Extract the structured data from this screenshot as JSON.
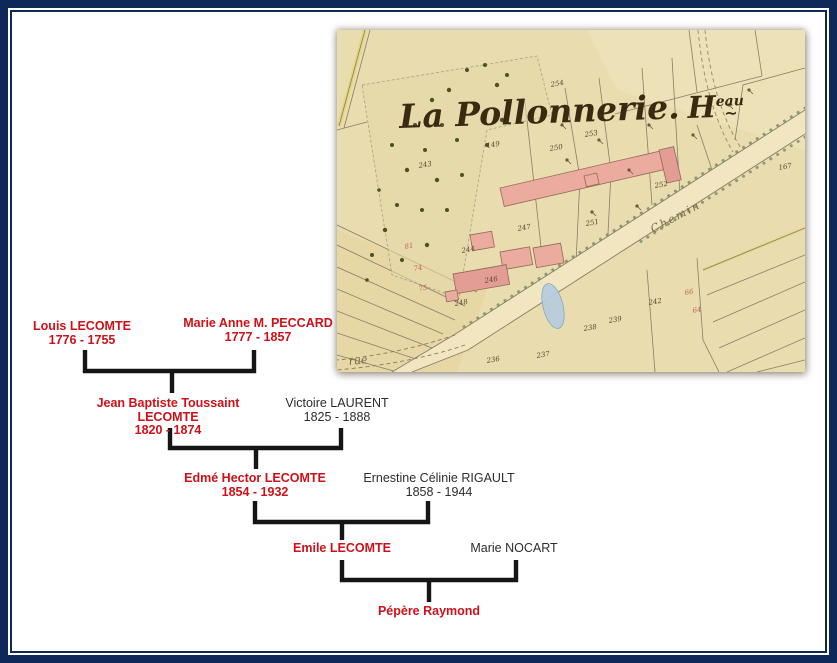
{
  "frame": {
    "border_color": "#0e2859"
  },
  "map": {
    "title_main": "La Pollonnerie.",
    "title_h": "H",
    "title_sup": "eau",
    "road_label": "Chemin",
    "corner_label": "rue",
    "paper_color": "#e9dcae",
    "building_color": "#ecab9f",
    "pond_color": "#b7cedd",
    "ink_color": "#857f68",
    "title_ink": "#3a2a12",
    "parcel_numbers": [
      {
        "t": "254",
        "x": 214,
        "y": 57,
        "c": "d"
      },
      {
        "t": "149",
        "x": 150,
        "y": 118,
        "c": "d"
      },
      {
        "t": "243",
        "x": 82,
        "y": 138,
        "c": "d"
      },
      {
        "t": "250",
        "x": 213,
        "y": 121,
        "c": "d"
      },
      {
        "t": "253",
        "x": 248,
        "y": 107,
        "c": "d"
      },
      {
        "t": "252",
        "x": 318,
        "y": 158,
        "c": "d"
      },
      {
        "t": "251",
        "x": 249,
        "y": 196,
        "c": "d"
      },
      {
        "t": "247",
        "x": 181,
        "y": 201,
        "c": "d"
      },
      {
        "t": "244",
        "x": 125,
        "y": 223,
        "c": "d"
      },
      {
        "t": "246",
        "x": 148,
        "y": 253,
        "c": "d"
      },
      {
        "t": "248",
        "x": 118,
        "y": 276,
        "c": "d"
      },
      {
        "t": "238",
        "x": 247,
        "y": 301,
        "c": "d"
      },
      {
        "t": "239",
        "x": 272,
        "y": 293,
        "c": "d"
      },
      {
        "t": "242",
        "x": 312,
        "y": 275,
        "c": "d"
      },
      {
        "t": "237",
        "x": 200,
        "y": 328,
        "c": "d"
      },
      {
        "t": "236",
        "x": 150,
        "y": 333,
        "c": "d"
      },
      {
        "t": "167",
        "x": 442,
        "y": 140,
        "c": "d"
      },
      {
        "t": "81",
        "x": 68,
        "y": 219,
        "c": "r"
      },
      {
        "t": "74",
        "x": 77,
        "y": 241,
        "c": "r"
      },
      {
        "t": "75",
        "x": 82,
        "y": 261,
        "c": "r"
      },
      {
        "t": "66",
        "x": 348,
        "y": 265,
        "c": "r"
      },
      {
        "t": "64",
        "x": 356,
        "y": 283,
        "c": "r"
      }
    ]
  },
  "tree": {
    "name_color": "#ce1118",
    "spouse_color": "#2d2d2d",
    "people": [
      {
        "name": "Louis LECOMTE",
        "dates": "1776 - 1755",
        "style": "red"
      },
      {
        "name": "Marie Anne M. PECCARD",
        "dates": "1777 - 1857",
        "style": "red"
      },
      {
        "name": "Jean Baptiste Toussaint LECOMTE",
        "dates": "1820 - 1874",
        "style": "red"
      },
      {
        "name": "Victoire LAURENT",
        "dates": "1825 - 1888",
        "style": "black"
      },
      {
        "name": "Edmé Hector LECOMTE",
        "dates": "1854 - 1932",
        "style": "red"
      },
      {
        "name": "Ernestine Célinie RIGAULT",
        "dates": "1858 - 1944",
        "style": "black"
      },
      {
        "name": "Emile LECOMTE",
        "dates": "",
        "style": "red"
      },
      {
        "name": "Marie NOCART",
        "dates": "",
        "style": "black"
      },
      {
        "name": "Pépère Raymond",
        "dates": "",
        "style": "red"
      }
    ]
  }
}
